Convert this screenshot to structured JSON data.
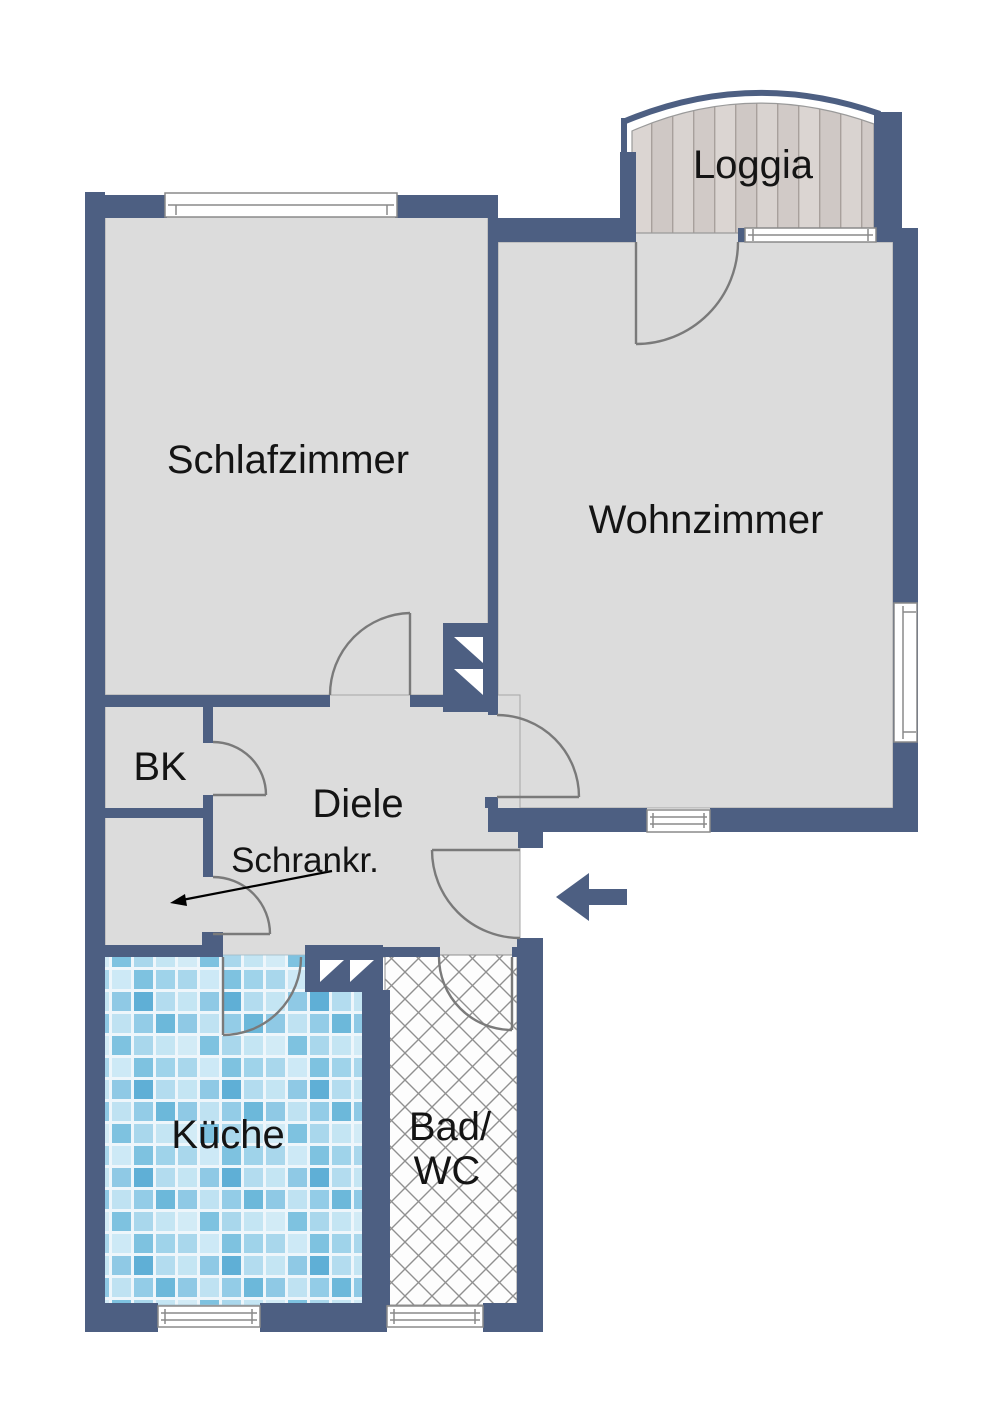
{
  "plan": {
    "title": "Apartment floor plan",
    "rooms": {
      "loggia": {
        "label": "Loggia"
      },
      "schlafzimmer": {
        "label": "Schlafzimmer"
      },
      "wohnzimmer": {
        "label": "Wohnzimmer"
      },
      "bk": {
        "label": "BK"
      },
      "diele": {
        "label": "Diele"
      },
      "schrankraum": {
        "label": "Schrankr."
      },
      "kueche": {
        "label": "Küche"
      },
      "bad": {
        "label_line1": "Bad/",
        "label_line2": "WC"
      }
    }
  },
  "colors": {
    "wall": "#4d5f82",
    "floor": "#dcdcdc",
    "door": "#7a7a7a",
    "window_stroke": "#8a8a8a",
    "label_text": "#141414",
    "wood_base": "#d8d2cf",
    "wood_line": "#a8a09c",
    "tile_grout": "#eef6fb",
    "tile_light": "#cfeaf6",
    "tile_mid": "#9ed2ea",
    "tile_dark": "#6fb9dc",
    "hatch_line": "#909090"
  }
}
